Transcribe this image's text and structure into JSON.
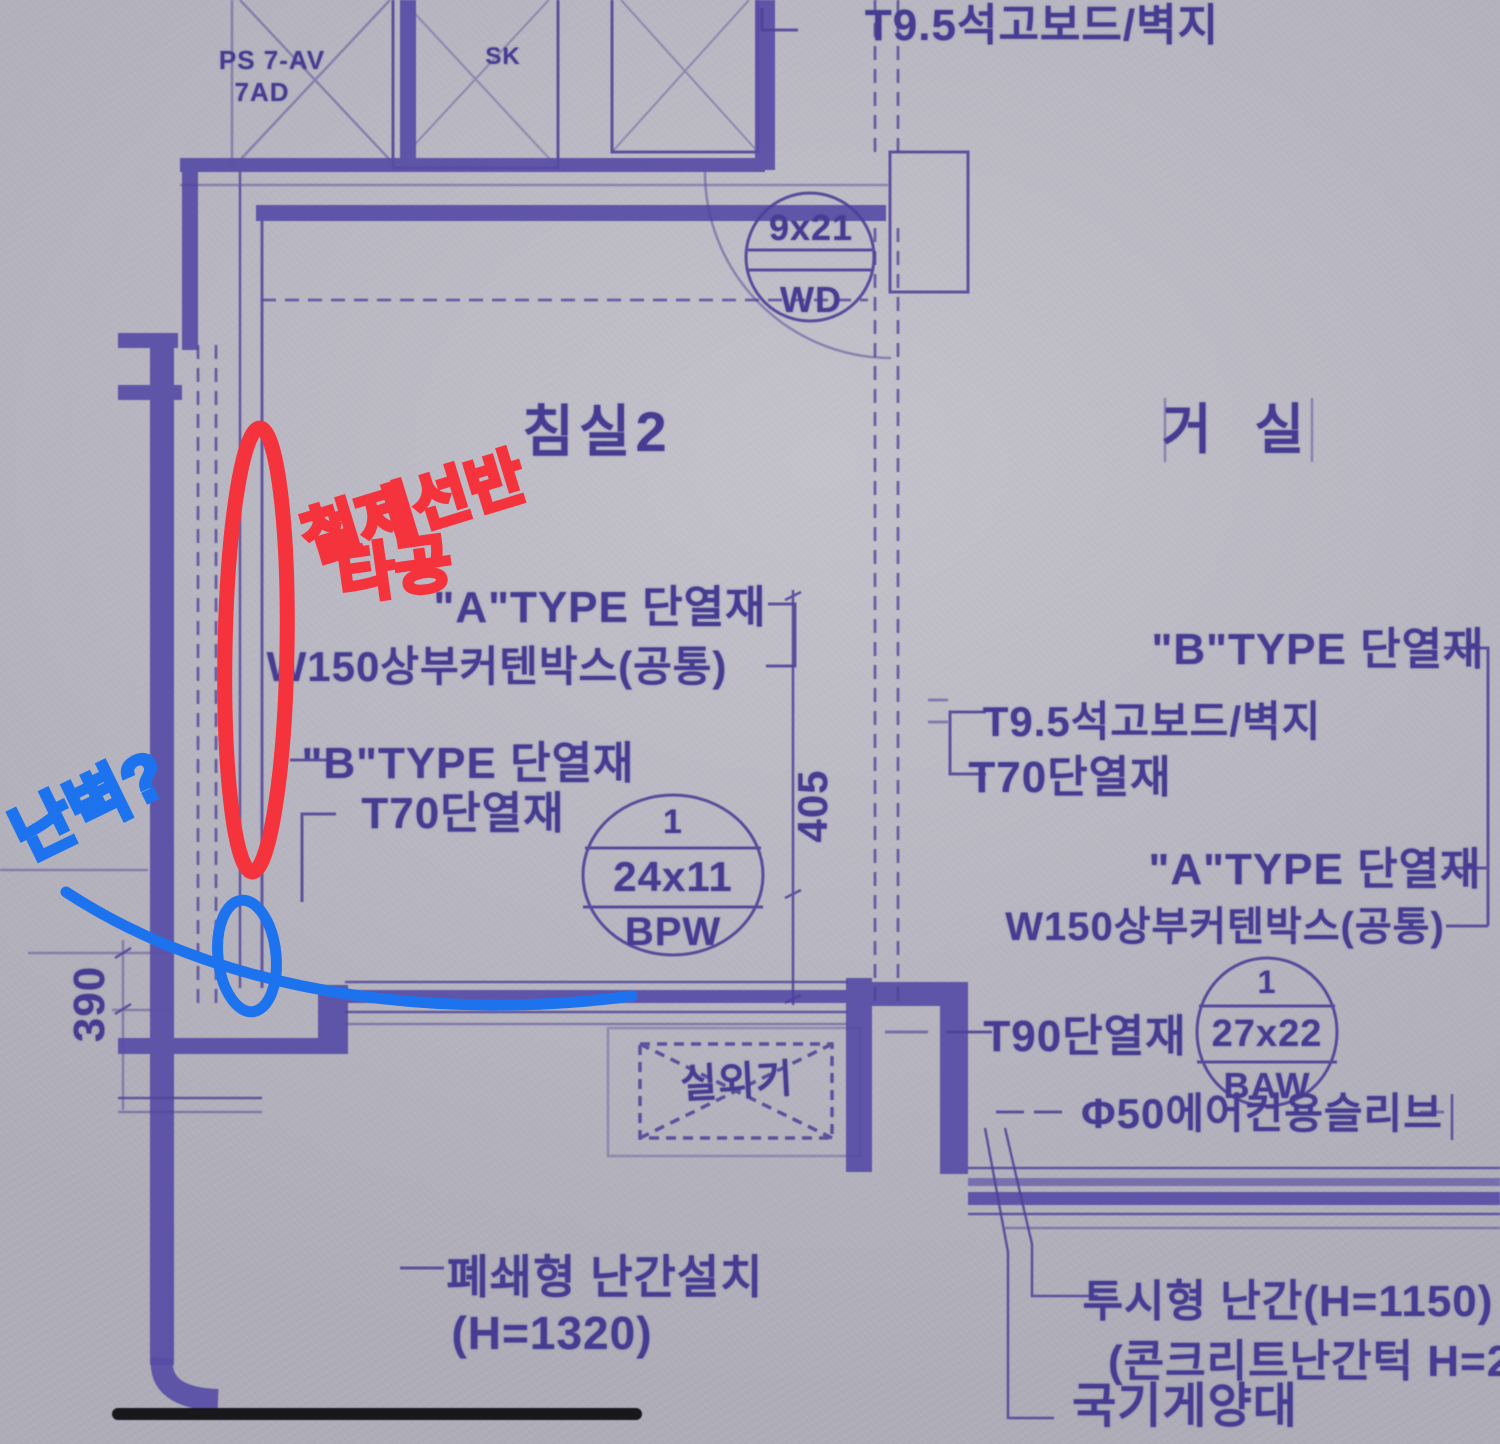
{
  "blueprint": {
    "top_note": "T9.5석고보드/벽지",
    "shaft": {
      "line1": "PS 7-AV",
      "line2": "7AD"
    },
    "sk": "SK",
    "door_wd": {
      "size": "9x21",
      "code": "WD"
    },
    "rooms": {
      "bedroom2": "침실2",
      "living": "거 실"
    },
    "callouts_left": {
      "a_type": "\"A\"TYPE 단열재",
      "curtain_box": "W150상부커텐박스(공통)",
      "b_type": "\"B\"TYPE 단열재",
      "t70": "T70단열재"
    },
    "window_bpw": {
      "num": "1",
      "size": "24x11",
      "code": "BPW"
    },
    "dims": {
      "d405": "405",
      "d390": "390"
    },
    "callouts_right": {
      "b_type": "\"B\"TYPE 단열재",
      "gypsum": "T9.5석고보드/벽지",
      "t70": "T70단열재",
      "a_type": "\"A\"TYPE 단열재",
      "curtain_box": "W150상부커텐박스(공통)",
      "t90": "T90단열재",
      "ac_sleeve": "Φ50에어컨용슬리브"
    },
    "window_baw": {
      "num": "1",
      "size": "27x22",
      "code": "BAW"
    },
    "outdoor_unit": "실외기",
    "rail_closed": {
      "line1": "폐쇄형 난간설치",
      "line2": "(H=1320)"
    },
    "rail_open": {
      "line1": "투시형 난간(H=1150)",
      "line2": "(콘크리트난간턱 H=250"
    },
    "flagpole": "국기게양대"
  },
  "annotations": {
    "red": {
      "line1": "철제선반",
      "line2": "타공"
    },
    "blue": {
      "note": "난벽?"
    }
  },
  "colors": {
    "line": "#4c4198",
    "wall": "#584da6",
    "text": "#463c92",
    "red": "#f5333d",
    "blue": "#1d72ee"
  }
}
